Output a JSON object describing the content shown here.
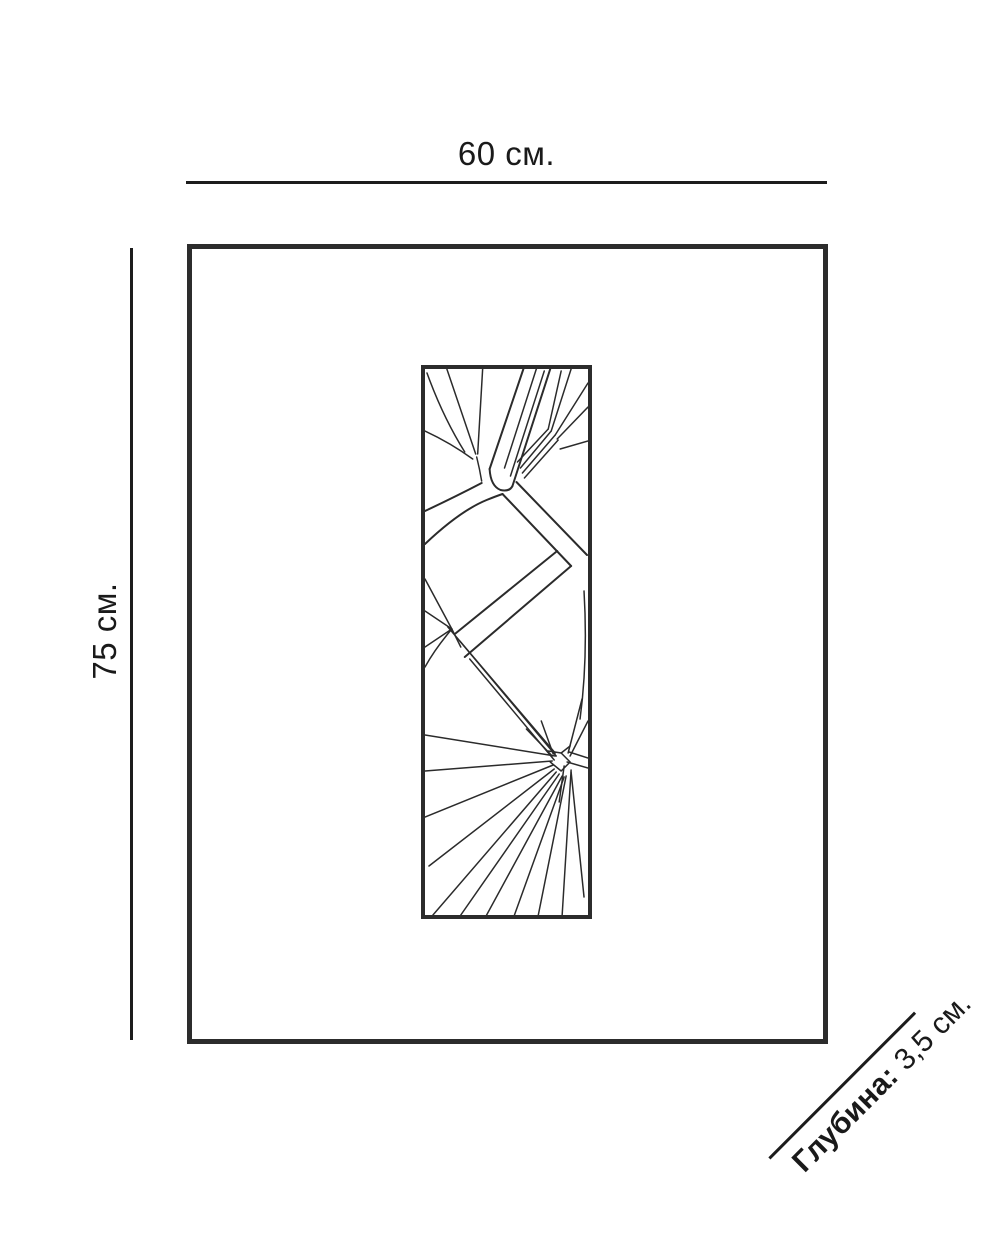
{
  "page": {
    "background": "#ffffff"
  },
  "diagram": {
    "width_dimension": {
      "label": "60 см."
    },
    "height_dimension": {
      "label": "75 см."
    },
    "depth_dimension": {
      "label_bold": "Глубина:",
      "label_value": "3,5 см."
    },
    "artwork": {
      "icon": "palm-leaf-line-art"
    }
  },
  "colors": {
    "dimension_line": "#1c1c1c",
    "frame_border": "#2c2c2c",
    "art_stroke": "#2b2b2b",
    "text": "#1a1a1a",
    "background": "#ffffff"
  }
}
